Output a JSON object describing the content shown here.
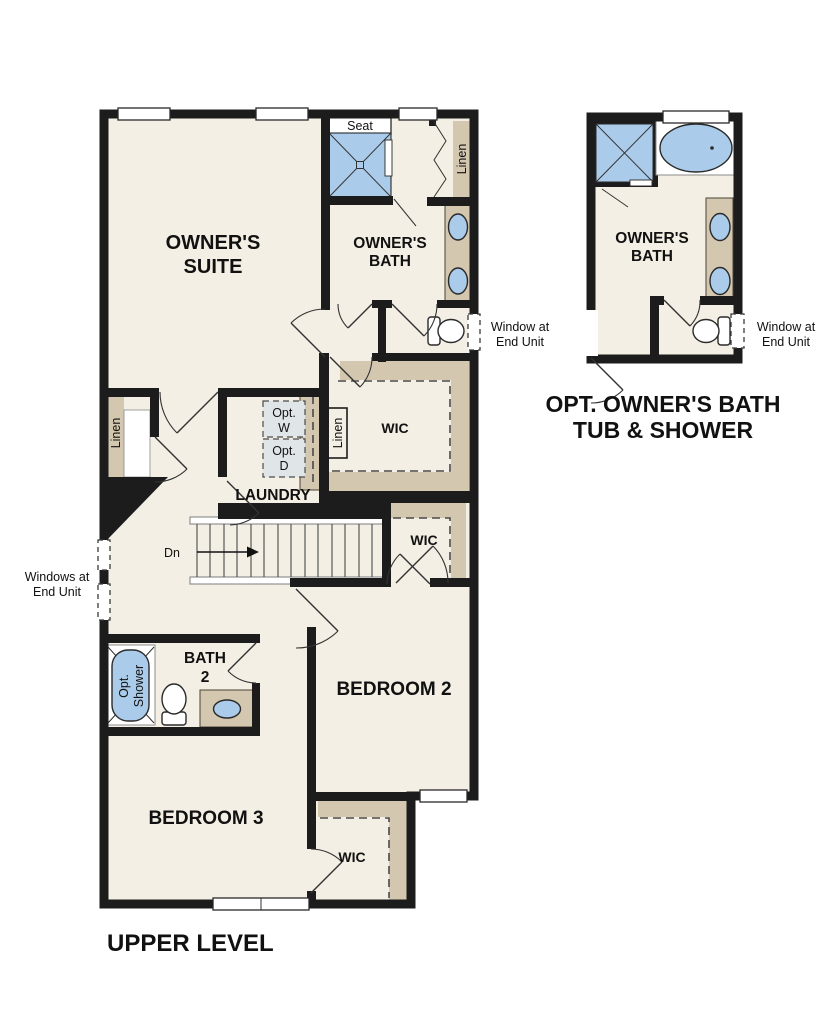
{
  "plan_title_note": "architectural floor plan",
  "colors": {
    "background": "#ffffff",
    "wall": "#1c1c1c",
    "floor": "#f4efe4",
    "counter_tan": "#d4c7af",
    "fixture_blue": "#aacbe9",
    "optional_fill": "#e0e5e8",
    "text": "#111111"
  },
  "main": {
    "caption": "UPPER LEVEL",
    "rooms": {
      "suite_line1": "OWNER'S",
      "suite_line2": "SUITE",
      "bath_line1": "OWNER'S",
      "bath_line2": "BATH",
      "bedroom2": "BEDROOM 2",
      "bedroom3": "BEDROOM 3",
      "bath2_line1": "BATH",
      "bath2_line2": "2",
      "laundry": "LAUNDRY",
      "wic": "WIC"
    },
    "labels": {
      "seat": "Seat",
      "linen": "Linen",
      "opt_w_line1": "Opt.",
      "opt_w_line2": "W",
      "opt_d_line1": "Opt.",
      "opt_d_line2": "D",
      "opt_shower_line1": "Opt.",
      "opt_shower_line2": "Shower",
      "stairs_down": "Dn"
    },
    "annotations": {
      "windows_end_unit_line1": "Windows at",
      "windows_end_unit_line2": "End Unit",
      "window_end_unit_line1": "Window at",
      "window_end_unit_line2": "End Unit"
    }
  },
  "option": {
    "caption_line1": "OPT. OWNER'S BATH",
    "caption_line2": "TUB & SHOWER",
    "rooms": {
      "bath_line1": "OWNER'S",
      "bath_line2": "BATH"
    },
    "annotations": {
      "window_end_unit_line1": "Window at",
      "window_end_unit_line2": "End Unit"
    }
  }
}
